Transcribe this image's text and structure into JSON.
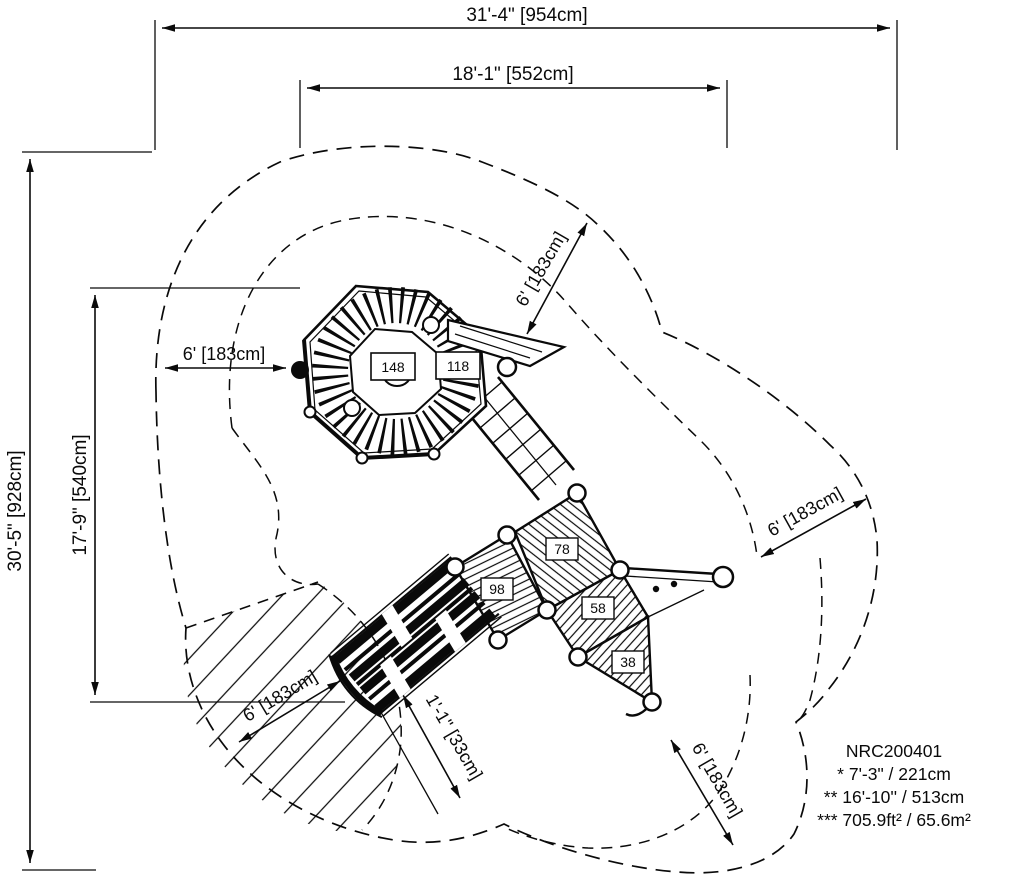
{
  "drawing": {
    "model_number": "NRC200401",
    "notes": {
      "line1": "* 7'-3\" / 221cm",
      "line2": "** 16'-10'' / 513cm",
      "line3": "*** 705.9ft² / 65.6m²"
    },
    "dimensions": {
      "overall_width": "31'-4\" [954cm]",
      "play_width": "18'-1\" [552cm]",
      "overall_height": "30'-5\" [928cm]",
      "play_height": "17'-9\" [540cm]",
      "use_zone_left": "6' [183cm]",
      "use_zone_top_right": "6' [183cm]",
      "use_zone_right": "6' [183cm]",
      "use_zone_bottom": "6' [183cm]",
      "use_zone_bottom_left": "6' [183cm]",
      "slide_exit": "1'-1\" [33cm]"
    },
    "deck_heights": {
      "d148": "148",
      "d118": "118",
      "d78": "78",
      "d98": "98",
      "d58": "58",
      "d38": "38"
    }
  },
  "colors": {
    "ink": "#0a0a0a",
    "background": "#ffffff"
  }
}
